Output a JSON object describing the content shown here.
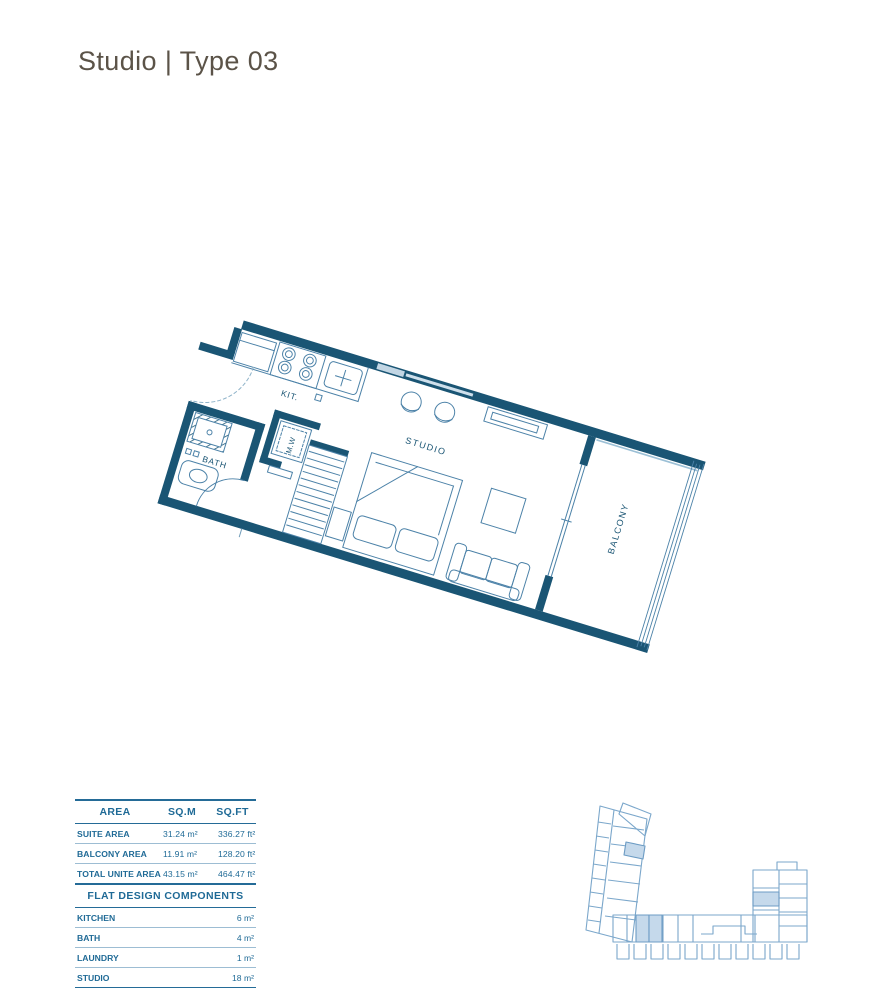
{
  "page": {
    "title": "Studio | Type 03",
    "title_color": "#5b5348"
  },
  "floor_plan": {
    "rotation_deg": 17,
    "wall_color": "#1a5574",
    "line_color": "#4c82a8",
    "labels": {
      "kitchen": "KIT.",
      "bath": "BATH",
      "microwave": "M.W",
      "studio": "STUDIO",
      "balcony": "BALCONY"
    }
  },
  "area_table": {
    "headers": [
      "AREA",
      "SQ.M",
      "SQ.FT"
    ],
    "rows": [
      {
        "label": "SUITE AREA",
        "sqm": "31.24 m²",
        "sqft": "336.27 ft²"
      },
      {
        "label": "BALCONY AREA",
        "sqm": "11.91 m²",
        "sqft": "128.20 ft²"
      },
      {
        "label": "TOTAL UNITE AREA",
        "sqm": "43.15 m²",
        "sqft": "464.47 ft²"
      }
    ]
  },
  "components_table": {
    "title": "FLAT DESIGN COMPONENTS",
    "rows": [
      {
        "label": "KITCHEN",
        "value": "6 m²"
      },
      {
        "label": "BATH",
        "value": "4 m²"
      },
      {
        "label": "LAUNDRY",
        "value": "1 m²"
      },
      {
        "label": "STUDIO",
        "value": "18 m²"
      }
    ]
  },
  "key_plan": {
    "outline_color": "#7ba7cb",
    "highlight_fill": "#c5d9eb",
    "highlight_stroke": "#6d9cc4"
  }
}
